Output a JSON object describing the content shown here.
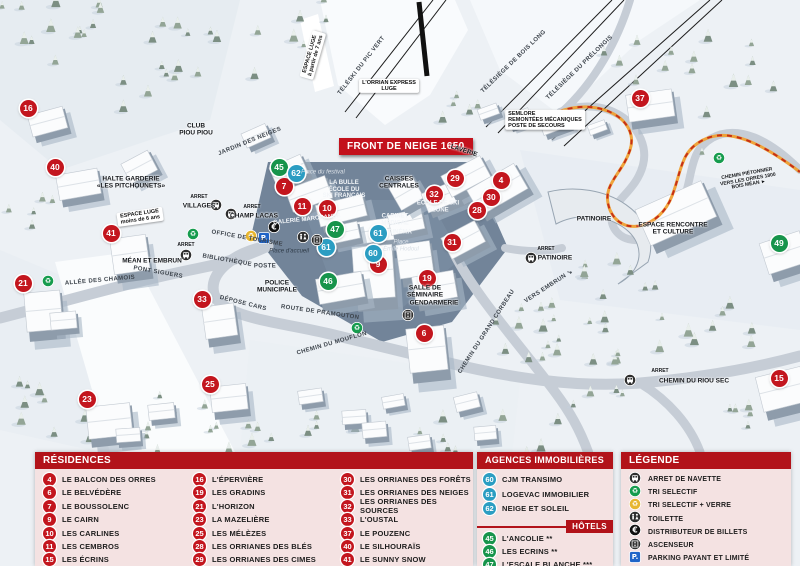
{
  "colors": {
    "residence": "#c3161e",
    "hotel": "#17944b",
    "agence": "#2b9dc2",
    "header": "#b2131a",
    "panel_bg": "#f4e2e2",
    "parking": "#1f64c8",
    "glass": "#e7b630",
    "recycle": "#169c4e",
    "dark_icon": "#2e2e2e"
  },
  "map": {
    "banner": "FRONT DE NEIGE 1650",
    "markers": [
      {
        "n": "16",
        "x": 28,
        "y": 108,
        "type": "residence"
      },
      {
        "n": "40",
        "x": 55,
        "y": 167,
        "type": "residence"
      },
      {
        "n": "41",
        "x": 111,
        "y": 233,
        "type": "residence"
      },
      {
        "n": "21",
        "x": 23,
        "y": 283,
        "type": "residence"
      },
      {
        "n": "33",
        "x": 202,
        "y": 299,
        "type": "residence"
      },
      {
        "n": "23",
        "x": 87,
        "y": 399,
        "type": "residence"
      },
      {
        "n": "25",
        "x": 210,
        "y": 384,
        "type": "residence"
      },
      {
        "n": "7",
        "x": 284,
        "y": 186,
        "type": "residence"
      },
      {
        "n": "11",
        "x": 302,
        "y": 206,
        "type": "residence"
      },
      {
        "n": "10",
        "x": 327,
        "y": 208,
        "type": "residence"
      },
      {
        "n": "9",
        "x": 378,
        "y": 264,
        "type": "residence"
      },
      {
        "n": "32",
        "x": 434,
        "y": 194,
        "type": "residence"
      },
      {
        "n": "19",
        "x": 427,
        "y": 278,
        "type": "residence"
      },
      {
        "n": "6",
        "x": 424,
        "y": 333,
        "type": "residence"
      },
      {
        "n": "31",
        "x": 452,
        "y": 242,
        "type": "residence"
      },
      {
        "n": "29",
        "x": 455,
        "y": 178,
        "type": "residence"
      },
      {
        "n": "4",
        "x": 501,
        "y": 180,
        "type": "residence"
      },
      {
        "n": "30",
        "x": 491,
        "y": 197,
        "type": "residence"
      },
      {
        "n": "28",
        "x": 477,
        "y": 210,
        "type": "residence"
      },
      {
        "n": "37",
        "x": 640,
        "y": 98,
        "type": "residence"
      },
      {
        "n": "15",
        "x": 779,
        "y": 378,
        "type": "residence"
      },
      {
        "n": "45",
        "x": 279,
        "y": 167,
        "type": "hotel"
      },
      {
        "n": "47",
        "x": 335,
        "y": 229,
        "type": "hotel"
      },
      {
        "n": "46",
        "x": 328,
        "y": 281,
        "type": "hotel"
      },
      {
        "n": "49",
        "x": 779,
        "y": 243,
        "type": "hotel"
      },
      {
        "n": "62",
        "x": 296,
        "y": 173,
        "type": "agence"
      },
      {
        "n": "61",
        "x": 326,
        "y": 247,
        "type": "agence"
      },
      {
        "n": "61",
        "x": 378,
        "y": 233,
        "type": "agence"
      },
      {
        "n": "60",
        "x": 373,
        "y": 253,
        "type": "agence"
      }
    ],
    "icons": [
      {
        "i": "bus",
        "x": 216,
        "y": 204
      },
      {
        "i": "bus",
        "x": 231,
        "y": 213
      },
      {
        "i": "bus",
        "x": 186,
        "y": 254
      },
      {
        "i": "bus",
        "x": 531,
        "y": 257
      },
      {
        "i": "bus",
        "x": 630,
        "y": 379
      },
      {
        "i": "recycle",
        "x": 48,
        "y": 280
      },
      {
        "i": "recycle",
        "x": 193,
        "y": 233
      },
      {
        "i": "recycle",
        "x": 357,
        "y": 327
      },
      {
        "i": "recycle",
        "x": 719,
        "y": 157
      },
      {
        "i": "recycle-glass",
        "x": 251,
        "y": 235
      },
      {
        "i": "parking",
        "x": 264,
        "y": 237
      },
      {
        "i": "euro",
        "x": 274,
        "y": 226
      },
      {
        "i": "toilet",
        "x": 303,
        "y": 236
      },
      {
        "i": "elevator",
        "x": 317,
        "y": 239
      },
      {
        "i": "elevator",
        "x": 408,
        "y": 314
      }
    ],
    "labels": [
      {
        "t": "TÉLÉSKI DU PIC VERT",
        "x": 362,
        "y": 66,
        "r": -52,
        "c": "road"
      },
      {
        "t": "L'ORRIAN EXPRESS\nLUGE",
        "x": 389,
        "y": 86,
        "r": 0,
        "c": "box"
      },
      {
        "t": "TÉLÉSIÈGE DE BOIS LONG",
        "x": 514,
        "y": 62,
        "r": -44,
        "c": "road"
      },
      {
        "t": "TÉLÉSIÈGE DU PRÉLONGIS",
        "x": 580,
        "y": 68,
        "r": -44,
        "c": "road"
      },
      {
        "t": "ESPACE LUGE\nà partir de 7 ans",
        "x": 313,
        "y": 55,
        "r": -74,
        "c": "box"
      },
      {
        "t": "SEMLORE\nREMONTÉES MÉCANIQUES\nPOSTE DE SECOURS",
        "x": 545,
        "y": 120,
        "r": 0,
        "c": "box-left"
      },
      {
        "t": "LAVERIE",
        "x": 464,
        "y": 151,
        "r": 18,
        "c": "place"
      },
      {
        "t": "CLUB\nPIOU PIOU",
        "x": 196,
        "y": 130,
        "r": 0,
        "c": "place"
      },
      {
        "t": "JARDIN DES NEIGES",
        "x": 250,
        "y": 142,
        "r": -22,
        "c": "road"
      },
      {
        "t": "HALTE GARDERIE\n«LES PITCHOUNETS»",
        "x": 131,
        "y": 183,
        "r": 0,
        "c": "place"
      },
      {
        "t": "ESPACE LUGE\nmoins de 6 ans",
        "x": 140,
        "y": 217,
        "r": -8,
        "c": "box"
      },
      {
        "t": "ARRET",
        "x": 199,
        "y": 198,
        "r": 0,
        "c": "tiny"
      },
      {
        "t": "VILLAGES",
        "x": 199,
        "y": 206,
        "r": 0,
        "c": "place"
      },
      {
        "t": "ARRET",
        "x": 252,
        "y": 208,
        "r": 0,
        "c": "tiny"
      },
      {
        "t": "CHAMP LACAS",
        "x": 254,
        "y": 216,
        "r": 0,
        "c": "place"
      },
      {
        "t": "ARRET",
        "x": 186,
        "y": 246,
        "r": 0,
        "c": "tiny"
      },
      {
        "t": "MÉAN ET EMBRUN",
        "x": 152,
        "y": 261,
        "r": 0,
        "c": "place"
      },
      {
        "t": "ALLÉE DES CHAMOIS",
        "x": 100,
        "y": 281,
        "r": -5,
        "c": "road"
      },
      {
        "t": "PONT SIGUERS",
        "x": 158,
        "y": 273,
        "r": 10,
        "c": "road"
      },
      {
        "t": "ROUTE DE PRAMOUTON",
        "x": 320,
        "y": 313,
        "r": 8,
        "c": "road"
      },
      {
        "t": "CHEMIN DU MOUFLON",
        "x": 332,
        "y": 344,
        "r": -16,
        "c": "road"
      },
      {
        "t": "CHEMIN DU GRAND CORBEAU",
        "x": 487,
        "y": 332,
        "r": -57,
        "c": "road"
      },
      {
        "t": "VERS EMBRUN ↘",
        "x": 549,
        "y": 287,
        "r": -33,
        "c": "road"
      },
      {
        "t": "CHEMIN PIÉTONNIER\nVERS LES ORRES 1800\nBOIS MÉAN ►",
        "x": 748,
        "y": 180,
        "r": -10,
        "c": "tiny"
      },
      {
        "t": "ARRET",
        "x": 546,
        "y": 250,
        "r": 0,
        "c": "tiny"
      },
      {
        "t": "PATINOIRE",
        "x": 555,
        "y": 258,
        "r": 0,
        "c": "place"
      },
      {
        "t": "ARRET",
        "x": 660,
        "y": 372,
        "r": 0,
        "c": "tiny"
      },
      {
        "t": "CHEMIN DU RIOU SEC",
        "x": 694,
        "y": 381,
        "r": 0,
        "c": "place"
      },
      {
        "t": "PATINOIRE",
        "x": 594,
        "y": 219,
        "r": 0,
        "c": "place"
      },
      {
        "t": "ESPACE RENCONTRE\nET CULTURE",
        "x": 673,
        "y": 229,
        "r": 0,
        "c": "place"
      },
      {
        "t": "CAISSES\nCENTRALES",
        "x": 399,
        "y": 183,
        "r": 0,
        "c": "place"
      },
      {
        "t": "Place du festival",
        "x": 323,
        "y": 173,
        "r": 0,
        "c": "italic-light"
      },
      {
        "t": "LA BULLE\nÉCOLE DU\nSKI FRANÇAIS",
        "x": 344,
        "y": 190,
        "r": 0,
        "c": "white"
      },
      {
        "t": "GALERIE MARCHANDE",
        "x": 307,
        "y": 220,
        "r": -6,
        "c": "white"
      },
      {
        "t": "ÉCOLE DE SKI\nOZONE",
        "x": 438,
        "y": 207,
        "r": 0,
        "c": "white"
      },
      {
        "t": "CABINET\nMÉDICAL",
        "x": 395,
        "y": 220,
        "r": 0,
        "c": "white"
      },
      {
        "t": "CINÉMA",
        "x": 400,
        "y": 233,
        "r": 0,
        "c": "white"
      },
      {
        "t": "Place\nÉmile Hodoul",
        "x": 401,
        "y": 246,
        "r": 0,
        "c": "italic-light"
      },
      {
        "t": "OFFICE DE TOURISME",
        "x": 247,
        "y": 239,
        "r": 10,
        "c": "road"
      },
      {
        "t": "BIBLIOTHÈQUE",
        "x": 227,
        "y": 261,
        "r": 10,
        "c": "road"
      },
      {
        "t": "POSTE",
        "x": 265,
        "y": 267,
        "r": 0,
        "c": "road"
      },
      {
        "t": "DÉPOSE CARS",
        "x": 243,
        "y": 304,
        "r": 14,
        "c": "road"
      },
      {
        "t": "POLICE\nMUNICIPALE",
        "x": 277,
        "y": 287,
        "r": 0,
        "c": "place"
      },
      {
        "t": "Place d'accueil",
        "x": 289,
        "y": 252,
        "r": 0,
        "c": "italic"
      },
      {
        "t": "SALLE DE\nSÉMINAIRE",
        "x": 425,
        "y": 292,
        "r": 0,
        "c": "place"
      },
      {
        "t": "GENDARMERIE",
        "x": 434,
        "y": 303,
        "r": 0,
        "c": "place"
      }
    ]
  },
  "panels": {
    "residences": {
      "title": "RÉSIDENCES",
      "columns": [
        [
          {
            "n": "4",
            "label": "LE BALCON DES ORRES"
          },
          {
            "n": "6",
            "label": "LE BELVÉDÈRE"
          },
          {
            "n": "7",
            "label": "LE BOUSSOLENC"
          },
          {
            "n": "9",
            "label": "LE CAIRN"
          },
          {
            "n": "10",
            "label": "LES CARLINES"
          },
          {
            "n": "11",
            "label": "LES CEMBROS"
          },
          {
            "n": "15",
            "label": "LES ÉCRINS"
          }
        ],
        [
          {
            "n": "16",
            "label": "L'ÉPERVIÈRE"
          },
          {
            "n": "19",
            "label": "LES GRADINS"
          },
          {
            "n": "21",
            "label": "L'HORIZON"
          },
          {
            "n": "23",
            "label": "LA MAZELIÈRE"
          },
          {
            "n": "25",
            "label": "LES MÉLÈZES"
          },
          {
            "n": "28",
            "label": "LES ORRIANES DES BLÉS"
          },
          {
            "n": "29",
            "label": "LES ORRIANES DES CIMES"
          }
        ],
        [
          {
            "n": "30",
            "label": "LES ORRIANES DES FORÊTS"
          },
          {
            "n": "31",
            "label": "LES ORRIANES DES NEIGES"
          },
          {
            "n": "32",
            "label": "LES ORRIANES DES SOURCES"
          },
          {
            "n": "33",
            "label": "L'OUSTAL"
          },
          {
            "n": "37",
            "label": "LE POUZENC"
          },
          {
            "n": "40",
            "label": "LE SILHOURAÏS"
          },
          {
            "n": "41",
            "label": "LE SUNNY SNOW"
          }
        ]
      ]
    },
    "agences": {
      "title": "AGENCES IMMOBILIÈRES",
      "items": [
        {
          "n": "60",
          "label": "CJM TRANSIMO"
        },
        {
          "n": "61",
          "label": "LOGEVAC IMMOBILIER"
        },
        {
          "n": "62",
          "label": "NEIGE ET SOLEIL"
        }
      ]
    },
    "hotels": {
      "title": "HÔTELS",
      "items": [
        {
          "n": "45",
          "label": "L'ANCOLIE **"
        },
        {
          "n": "46",
          "label": "LES ECRINS **"
        },
        {
          "n": "47",
          "label": "L'ESCALE BLANCHE ***"
        },
        {
          "n": "49",
          "label": "LES TRAPPEURS **"
        }
      ]
    },
    "legende": {
      "title": "LÉGENDE",
      "items": [
        {
          "icon": "bus",
          "label": "ARRET DE NAVETTE"
        },
        {
          "icon": "recycle",
          "label": "TRI SELECTIF"
        },
        {
          "icon": "recycle-glass",
          "label": "TRI SELECTIF + VERRE"
        },
        {
          "icon": "toilet",
          "label": "TOILETTE"
        },
        {
          "icon": "euro",
          "label": "DISTRIBUTEUR DE BILLETS"
        },
        {
          "icon": "elevator",
          "label": "ASCENSEUR"
        },
        {
          "icon": "parking",
          "label": "PARKING PAYANT ET LIMITÉ"
        }
      ]
    }
  }
}
